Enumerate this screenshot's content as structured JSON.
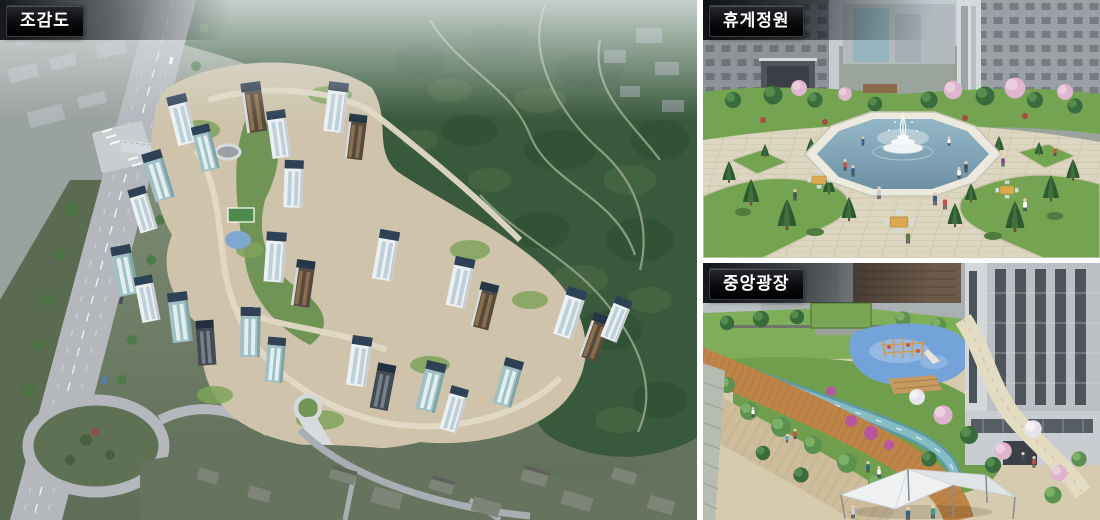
{
  "panels": {
    "aerial": {
      "label": "조감도"
    },
    "garden": {
      "label": "휴게정원"
    },
    "plaza": {
      "label": "중앙광장"
    }
  },
  "palette": {
    "label_background": "#0a0b0e",
    "label_text": "#ffffff",
    "panel_divider": "#ffffff",
    "sky_haze": "#b9c3c6",
    "forest_green": "#38593b",
    "city_gray": "#a2a9ad",
    "road_gray": "#b4b8bd",
    "complex_ground": "#cfc4ab",
    "tower_body_white": "#edf0f2",
    "tower_roof_navy": "#2e4157",
    "tower_glass_teal": "#9fc0c4",
    "tower_facade_brown": "#564a3e",
    "lawn_green": "#74a452",
    "plaza_paving": "#ddd6c1",
    "pond_water": "#7da6ba",
    "fountain_white": "#f2f6f8",
    "blossom_pink": "#e0b5cf",
    "playground_blue": "#74a3da",
    "boardwalk_wood": "#bf8447",
    "light_boardwalk": "#cdbd9b",
    "stream_teal": "#86bcc4",
    "canopy_white": "#eef0f1"
  }
}
